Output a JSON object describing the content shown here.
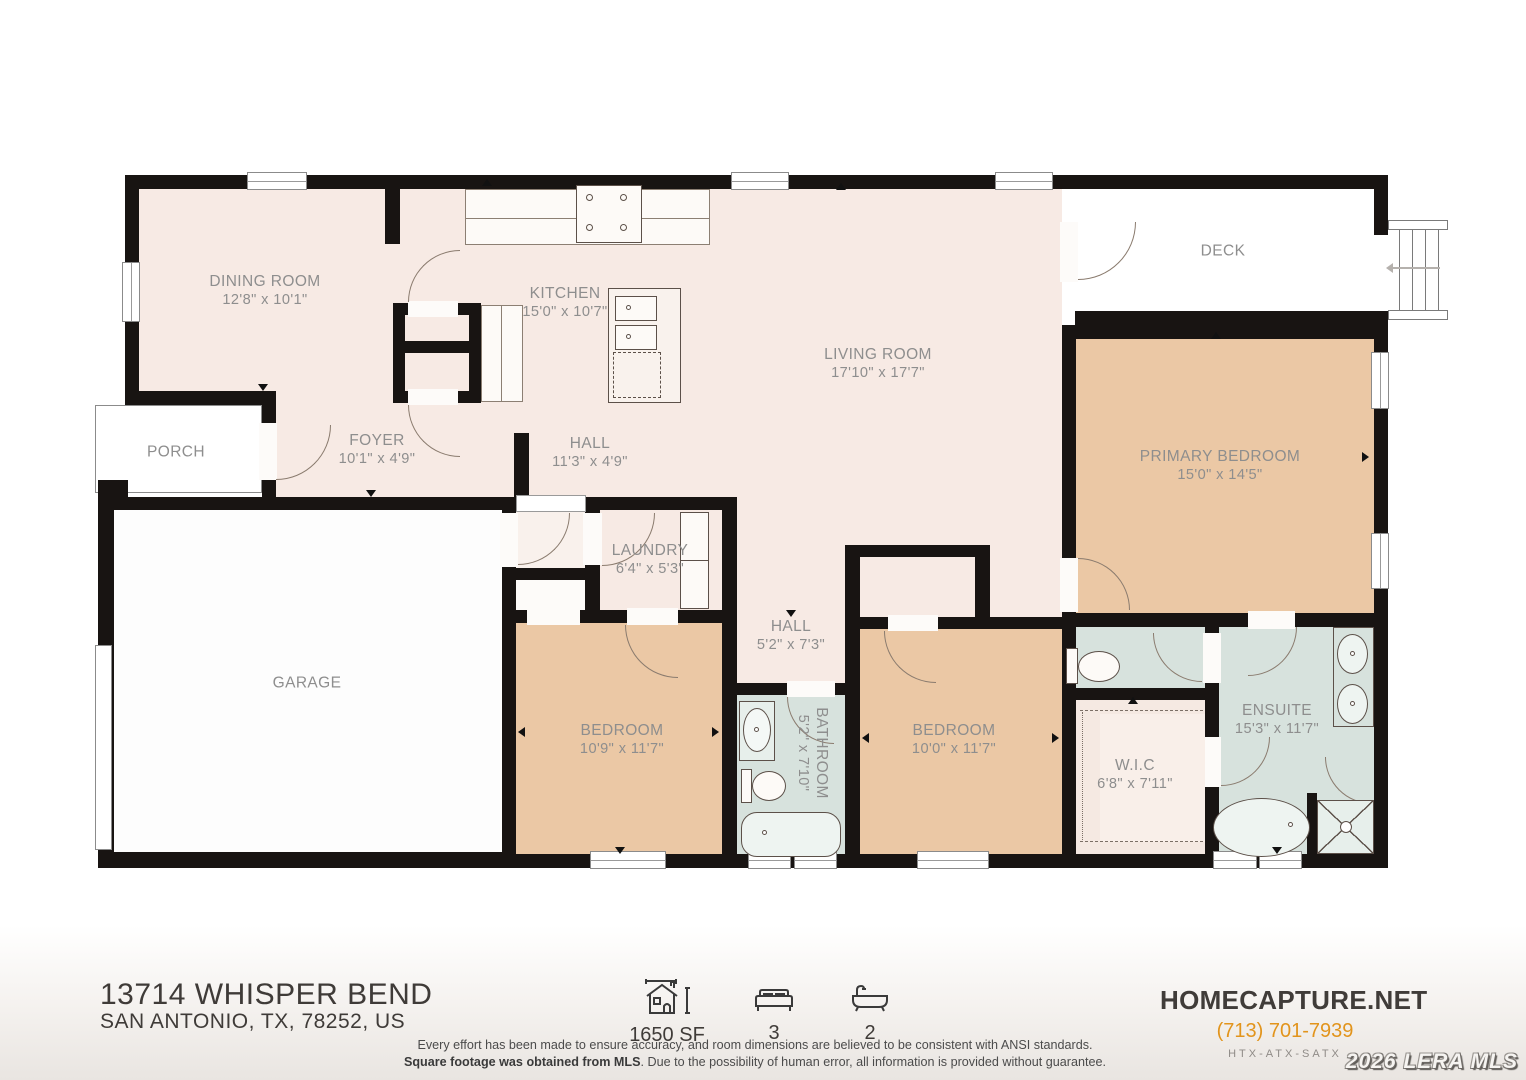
{
  "plan": {
    "rooms": {
      "dining": {
        "name": "DINING ROOM",
        "dims": "12'8\" x 10'1\""
      },
      "kitchen": {
        "name": "KITCHEN",
        "dims": "15'0\" x 10'7\""
      },
      "living": {
        "name": "LIVING ROOM",
        "dims": "17'10\" x 17'7\""
      },
      "deck": {
        "name": "DECK",
        "dims": ""
      },
      "primary": {
        "name": "PRIMARY BEDROOM",
        "dims": "15'0\" x 14'5\""
      },
      "porch": {
        "name": "PORCH",
        "dims": ""
      },
      "foyer": {
        "name": "FOYER",
        "dims": "10'1\" x 4'9\""
      },
      "hall1": {
        "name": "HALL",
        "dims": "11'3\" x 4'9\""
      },
      "garage": {
        "name": "GARAGE",
        "dims": ""
      },
      "laundry": {
        "name": "LAUNDRY",
        "dims": "6'4\" x 5'3\""
      },
      "hall2": {
        "name": "HALL",
        "dims": "5'2\" x 7'3\""
      },
      "bedroom1": {
        "name": "BEDROOM",
        "dims": "10'9\" x 11'7\""
      },
      "bathroom": {
        "name": "BATHROOM",
        "dims": "5'2\" x 7'10\""
      },
      "bedroom2": {
        "name": "BEDROOM",
        "dims": "10'0\" x 11'7\""
      },
      "ensuite": {
        "name": "ENSUITE",
        "dims": "15'3\" x 11'7\""
      },
      "wic": {
        "name": "W.I.C",
        "dims": "6'8\" x 7'11\""
      }
    },
    "colors": {
      "floor": "#f7eae4",
      "bedroom": "#ebc8a5",
      "bath": "#d7e2dd",
      "wall": "#181412",
      "label_text": "#8e8e8e"
    }
  },
  "footer": {
    "address_line1": "13714 WHISPER BEND",
    "address_line2": "SAN ANTONIO, TX, 78252, US",
    "stats": [
      {
        "icon": "area-icon",
        "value": "1650 SF"
      },
      {
        "icon": "bed-icon",
        "value": "3"
      },
      {
        "icon": "bath-icon",
        "value": "2"
      }
    ],
    "disclaimer_line1": "Every effort has been made to ensure accuracy, and room dimensions are believed to be consistent with ANSI standards.",
    "disclaimer_line2_bold": "Square footage was obtained from MLS",
    "disclaimer_line2_rest": ". Due to the possibility of human error, all information is provided without guarantee.",
    "brand_name": "HOMECAPTURE.NET",
    "brand_phone": "(713) 701-7939",
    "brand_tagline": "HTX-ATX-SATX",
    "watermark": "2026 LERA MLS",
    "accent_color": "#e2941c"
  }
}
